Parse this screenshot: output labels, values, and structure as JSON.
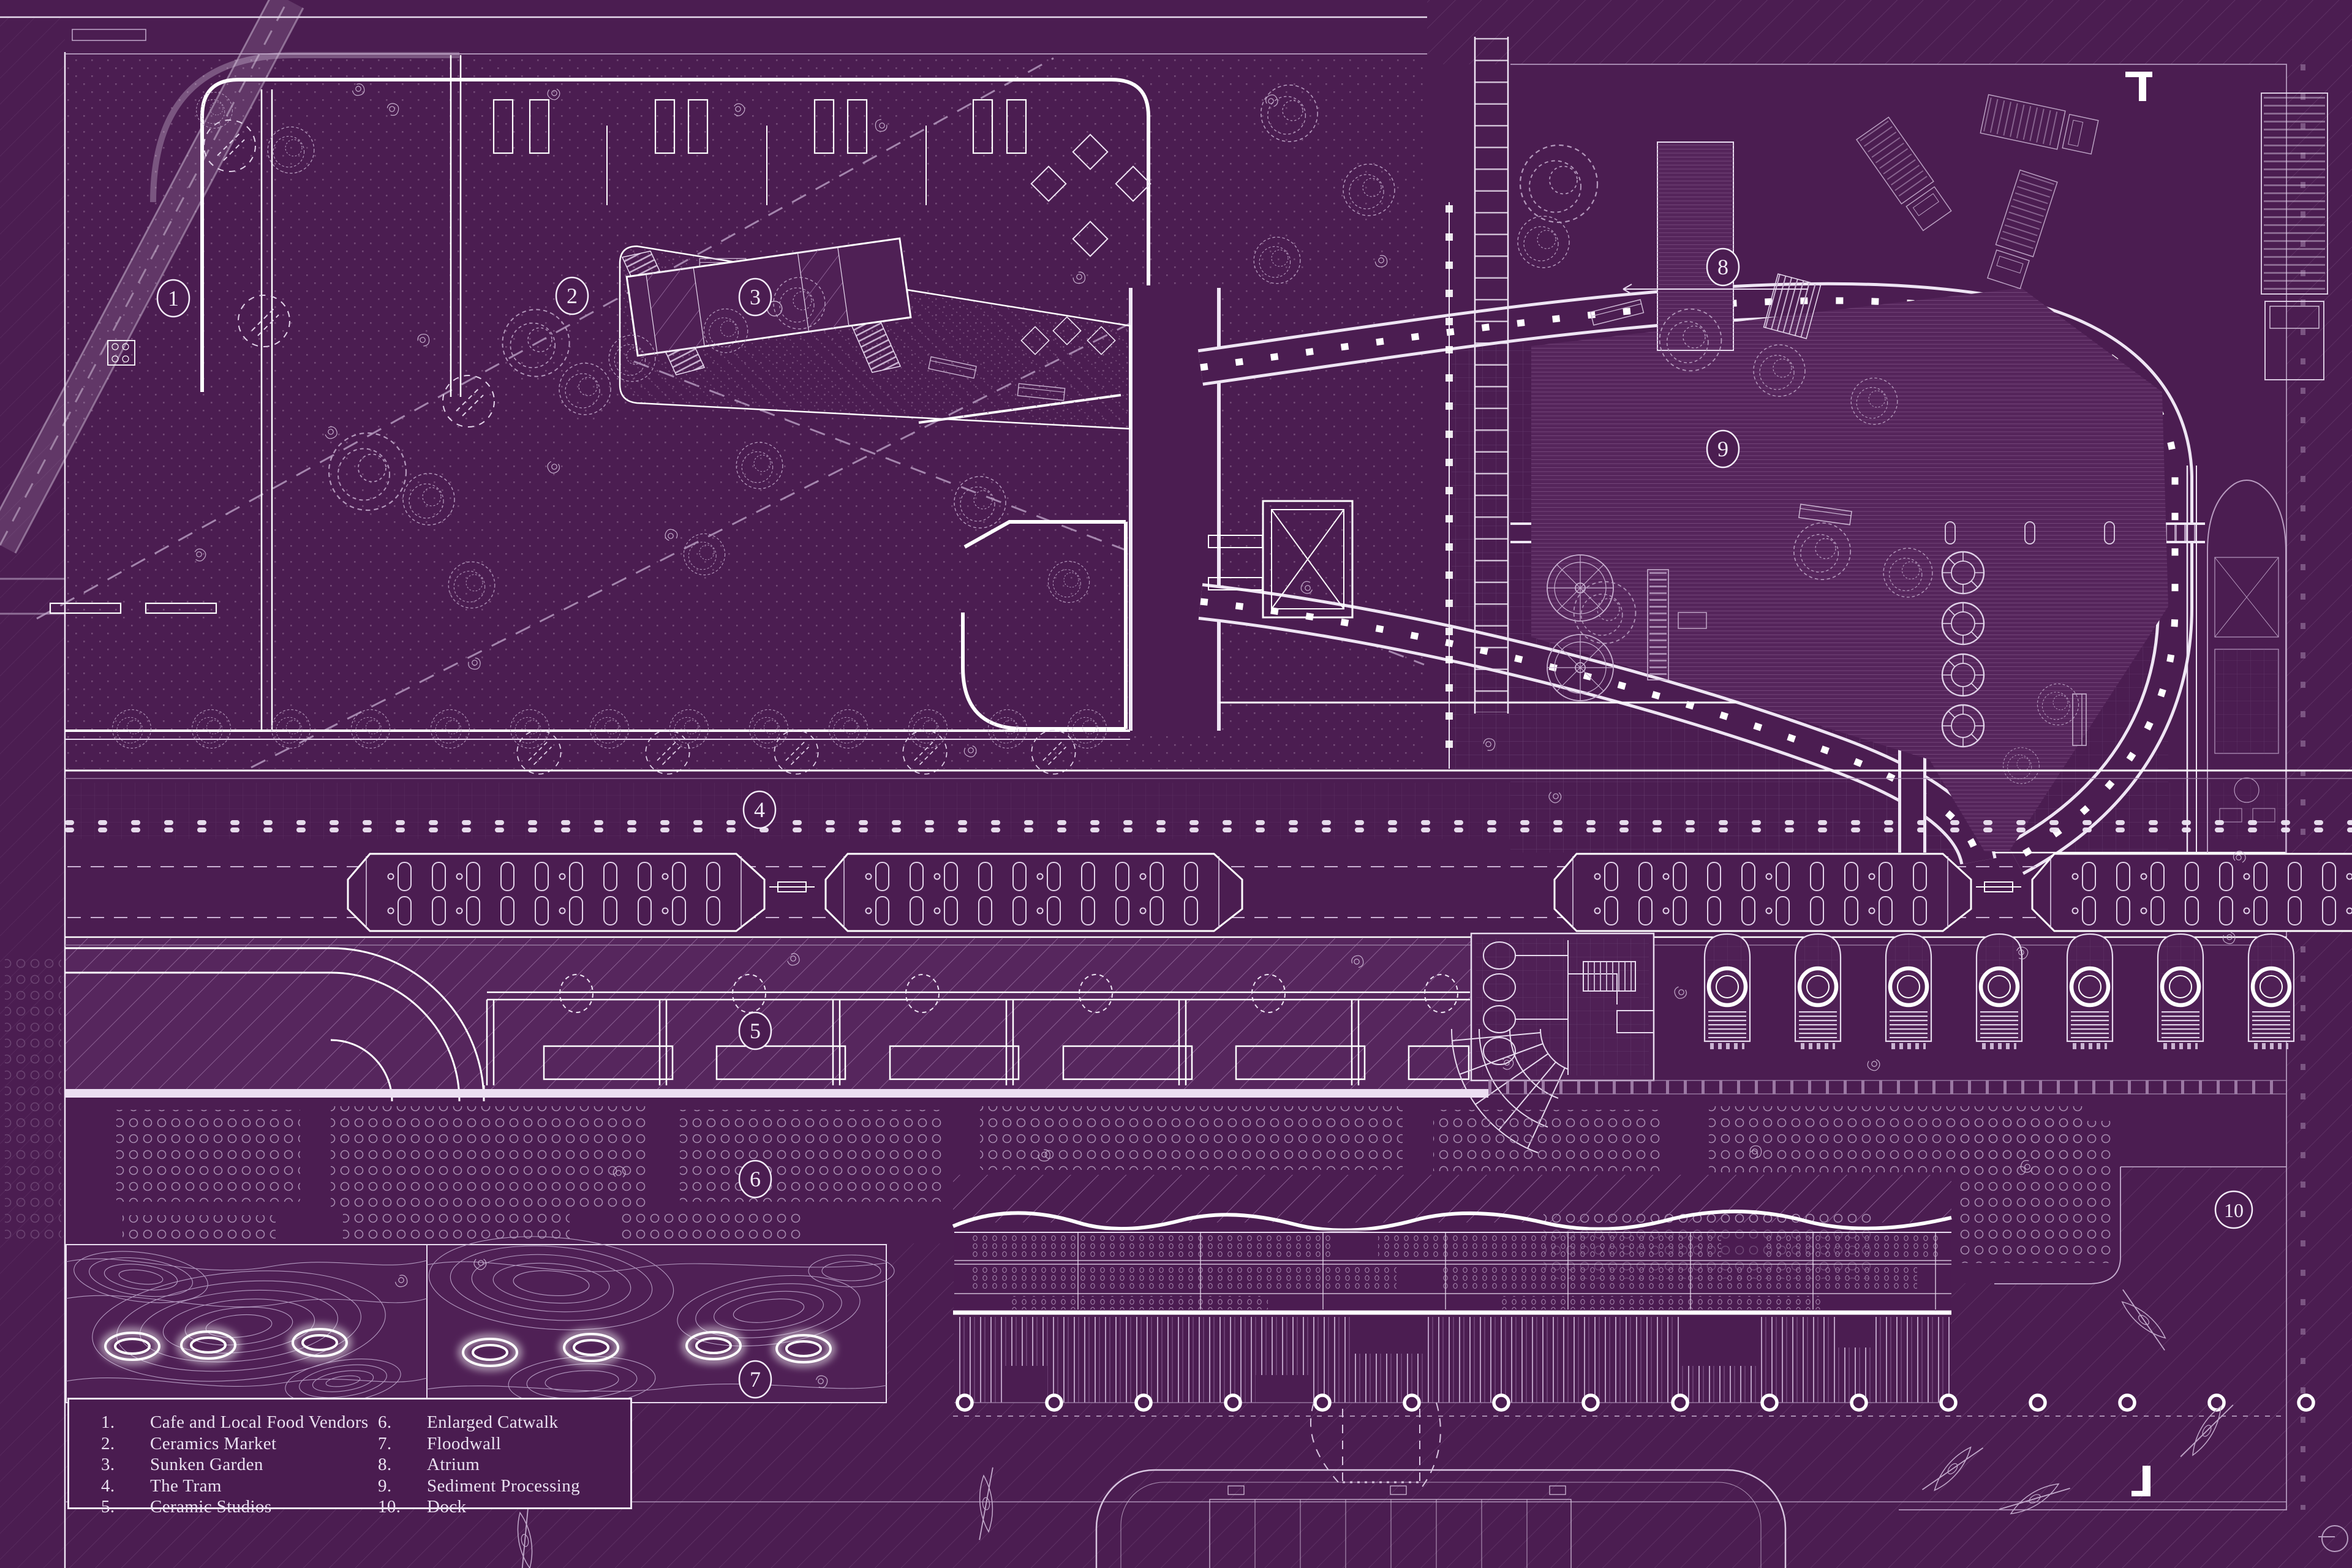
{
  "colors": {
    "background": "#4b1d51",
    "panel": "#4f2055",
    "linework": "#ffffff",
    "soft_line": "#e9dcf0",
    "faint_line": "#c2a9cc",
    "dim_line": "#a486ad",
    "hatch": "#8a5f92",
    "dots": "#7c547f",
    "water_hatch": "#663a6c",
    "grid": "#6d4476",
    "glow": "#ffffff",
    "legend_text": "#eae1f1"
  },
  "legend": {
    "items": [
      {
        "num": "1.",
        "label": "Cafe and Local Food Vendors"
      },
      {
        "num": "2.",
        "label": "Ceramics Market"
      },
      {
        "num": "3.",
        "label": "Sunken Garden"
      },
      {
        "num": "4.",
        "label": "The Tram"
      },
      {
        "num": "5.",
        "label": "Ceramic Studios"
      },
      {
        "num": "6.",
        "label": "Enlarged Catwalk"
      },
      {
        "num": "7.",
        "label": "Floodwall"
      },
      {
        "num": "8.",
        "label": "Atrium"
      },
      {
        "num": "9.",
        "label": "Sediment Processing"
      },
      {
        "num": "10.",
        "label": "Dock"
      }
    ]
  },
  "markers": [
    {
      "num": "1"
    },
    {
      "num": "2"
    },
    {
      "num": "3"
    },
    {
      "num": "4"
    },
    {
      "num": "5"
    },
    {
      "num": "6"
    },
    {
      "num": "7"
    },
    {
      "num": "8"
    },
    {
      "num": "9"
    },
    {
      "num": "10"
    }
  ]
}
